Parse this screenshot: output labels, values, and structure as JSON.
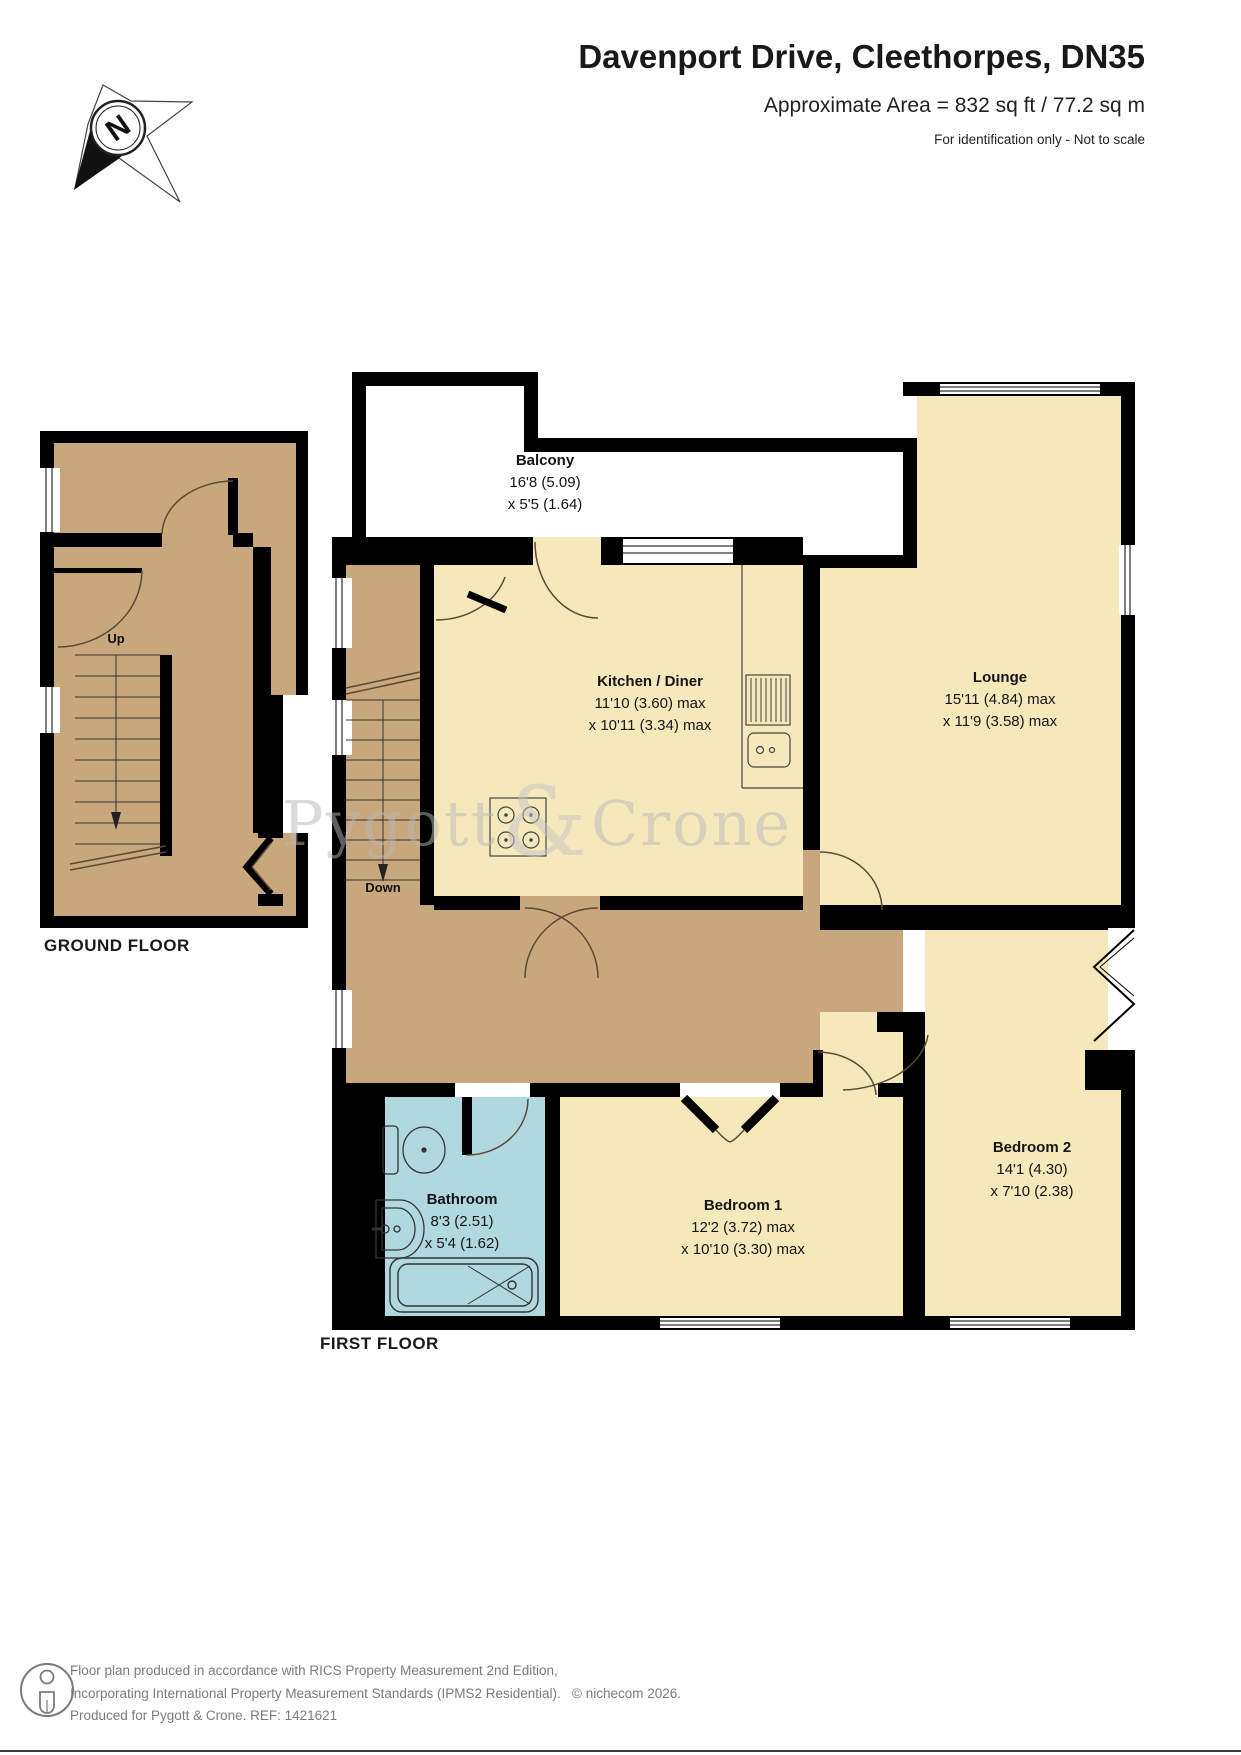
{
  "header": {
    "title": "Davenport Drive, Cleethorpes, DN35",
    "subtitle": "Approximate Area = 832 sq ft / 77.2 sq m",
    "note": "For identification only - Not to scale"
  },
  "compass": {
    "label": "N"
  },
  "floors": {
    "ground": {
      "label": "GROUND FLOOR",
      "stairs_label": "Up"
    },
    "first": {
      "label": "FIRST FLOOR",
      "stairs_label": "Down"
    }
  },
  "rooms": {
    "balcony": {
      "name": "Balcony",
      "dim1": "16'8 (5.09)",
      "dim2": "x 5'5 (1.64)"
    },
    "kitchen": {
      "name": "Kitchen / Diner",
      "dim1": "11'10 (3.60) max",
      "dim2": "x 10'11 (3.34) max"
    },
    "lounge": {
      "name": "Lounge",
      "dim1": "15'11 (4.84) max",
      "dim2": "x 11'9 (3.58) max"
    },
    "bathroom": {
      "name": "Bathroom",
      "dim1": "8'3 (2.51)",
      "dim2": "x 5'4 (1.62)"
    },
    "bedroom1": {
      "name": "Bedroom 1",
      "dim1": "12'2 (3.72) max",
      "dim2": "x 10'10 (3.30) max"
    },
    "bedroom2": {
      "name": "Bedroom 2",
      "dim1": "14'1 (4.30)",
      "dim2": "x 7'10 (2.38)"
    }
  },
  "watermark": {
    "part1": "Pygott",
    "amp": "&",
    "part2": "Crone"
  },
  "footer": {
    "line1": "Floor plan produced in accordance with RICS Property Measurement 2nd Edition,",
    "line2": "Incorporating International Property Measurement Standards (IPMS2 Residential).",
    "copyright": "© nichecom 2026.",
    "line3": "Produced for Pygott & Crone.   REF:  1421621"
  },
  "colors": {
    "room": "#F5E9BC",
    "hall": "#C8A77C",
    "bath": "#B0D8DF",
    "wall": "#000000"
  }
}
